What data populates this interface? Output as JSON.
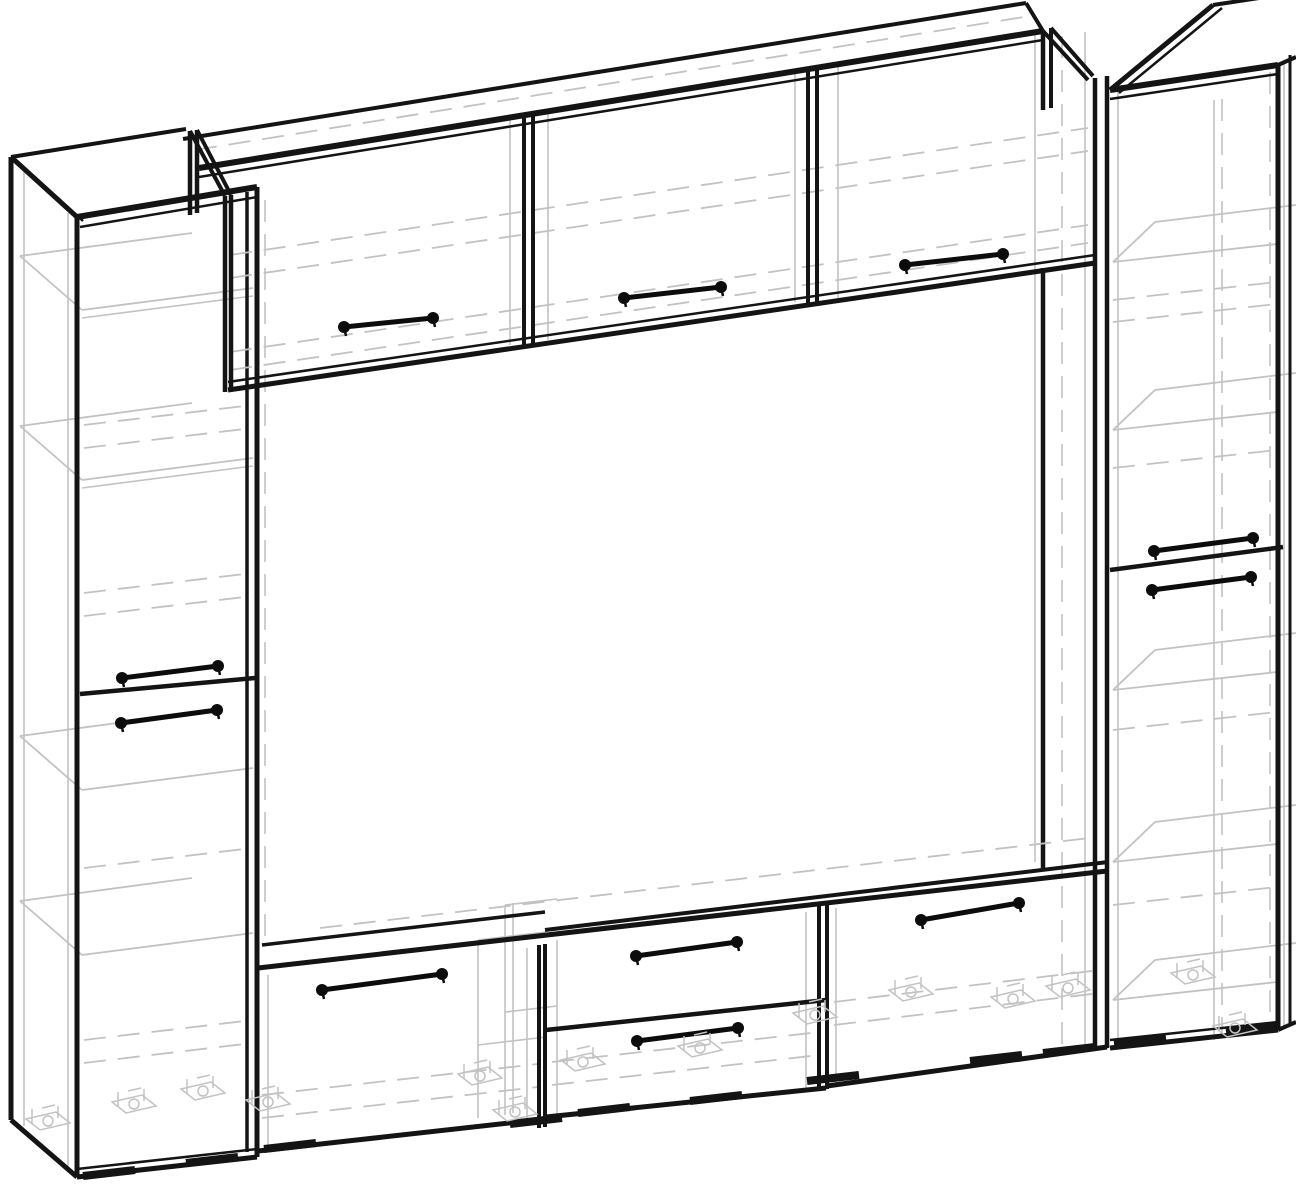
{
  "meta": {
    "type": "furniture-wireframe-diagram",
    "subject": "wall-unit-tv-entertainment-center",
    "canvas": {
      "w": 1296,
      "h": 1194
    },
    "background": "#ffffff"
  },
  "style": {
    "edge_color": "#141414",
    "hidden_color": "#c2c2c2",
    "handle_color": "#0c0c0c",
    "dash_pattern": "22 12",
    "pad_len": 52,
    "pad_drop": -6,
    "pad_width": 8
  },
  "legend": {
    "edges_format": "[x1,y1,x2,y2,strokeWidth] visible edge, black",
    "hidden_format": "[x1,y1,x2,y2,strokeWidth,dashedFlag] hidden/internal edge, light gray",
    "handles_format": "bar handle with ball ends, from->to",
    "pads_format": "[x,y] black floor pad strip",
    "glides_format": "[x,y] gray adjustable-foot hardware glyph"
  },
  "components": {
    "left-tall-cabinet": {
      "edges": [
        [
          11,
          157,
          11,
          1120,
          5
        ],
        [
          11,
          157,
          77,
          217,
          5
        ],
        [
          17,
          161,
          83,
          221,
          2.5
        ],
        [
          11,
          1120,
          77,
          1177,
          5
        ],
        [
          77,
          217,
          77,
          1177,
          5
        ],
        [
          77,
          217,
          257,
          187,
          6
        ],
        [
          80,
          227,
          257,
          197,
          2.5
        ],
        [
          11,
          157,
          186,
          129,
          4
        ],
        [
          247,
          192,
          247,
          1152,
          3.5
        ],
        [
          257,
          187,
          257,
          1157,
          5
        ],
        [
          77,
          1177,
          257,
          1157,
          5
        ],
        [
          77,
          1169,
          257,
          1149,
          2.5
        ],
        [
          80,
          694,
          255,
          678,
          4.5
        ]
      ],
      "hidden": [
        [
          24,
          168,
          24,
          1126,
          1.6,
          0
        ],
        [
          68,
          213,
          68,
          1172,
          1.6,
          0
        ],
        [
          265,
          200,
          265,
          945,
          1.6,
          1
        ],
        [
          82,
          310,
          253,
          288,
          1.8,
          0
        ],
        [
          82,
          310,
          20,
          256,
          1.8,
          0
        ],
        [
          20,
          256,
          192,
          233,
          1.8,
          0
        ],
        [
          82,
          318,
          253,
          296,
          1.6,
          0
        ],
        [
          82,
          480,
          253,
          458,
          1.8,
          0
        ],
        [
          82,
          480,
          20,
          426,
          1.8,
          0
        ],
        [
          20,
          426,
          192,
          403,
          1.8,
          0
        ],
        [
          82,
          488,
          253,
          466,
          1.6,
          0
        ],
        [
          82,
          790,
          253,
          768,
          1.8,
          0
        ],
        [
          82,
          790,
          20,
          736,
          1.8,
          0
        ],
        [
          20,
          736,
          192,
          713,
          1.8,
          0
        ],
        [
          82,
          955,
          253,
          933,
          1.8,
          0
        ],
        [
          82,
          955,
          20,
          901,
          1.8,
          0
        ],
        [
          20,
          901,
          192,
          878,
          1.8,
          0
        ],
        [
          84,
          425,
          253,
          405,
          1.8,
          1
        ],
        [
          84,
          448,
          253,
          428,
          1.8,
          1
        ],
        [
          84,
          593,
          253,
          573,
          1.8,
          1
        ],
        [
          84,
          616,
          253,
          596,
          1.8,
          1
        ],
        [
          84,
          868,
          253,
          848,
          1.8,
          1
        ],
        [
          84,
          1040,
          253,
          1020,
          1.8,
          1
        ],
        [
          84,
          1063,
          253,
          1043,
          1.8,
          1
        ]
      ],
      "handles": [
        {
          "name": "left-cabinet-upper-door-handle",
          "from": [
            122,
            678
          ],
          "to": [
            218,
            666
          ]
        },
        {
          "name": "left-cabinet-lower-door-handle",
          "from": [
            121,
            723
          ],
          "to": [
            217,
            710
          ]
        }
      ]
    },
    "top-bridge-cabinet": {
      "edges": [
        [
          190,
          131,
          190,
          215,
          4.5
        ],
        [
          197,
          130,
          197,
          213,
          4.5
        ],
        [
          190,
          131,
          225,
          196,
          4
        ],
        [
          197,
          130,
          231,
          195,
          4
        ],
        [
          225,
          196,
          225,
          392,
          4.5
        ],
        [
          231,
          195,
          231,
          390,
          4.5
        ],
        [
          199,
          168,
          1043,
          31,
          6
        ],
        [
          199,
          177,
          1043,
          40,
          2.5
        ],
        [
          183,
          139,
          1026,
          3,
          4
        ],
        [
          1026,
          3,
          1043,
          31,
          4
        ],
        [
          228,
          390,
          1095,
          263,
          5
        ],
        [
          228,
          382,
          1095,
          255,
          2.5
        ],
        [
          524,
          116,
          524,
          348,
          4
        ],
        [
          533,
          115,
          533,
          346,
          4
        ],
        [
          808,
          70,
          808,
          306,
          4
        ],
        [
          817,
          69,
          817,
          304,
          4
        ],
        [
          1043,
          31,
          1043,
          110,
          4.5
        ],
        [
          1051,
          28,
          1051,
          108,
          4
        ],
        [
          1043,
          31,
          1088,
          80,
          4
        ],
        [
          1051,
          28,
          1093,
          76,
          4
        ],
        [
          1043,
          268,
          1043,
          868,
          4.5
        ]
      ],
      "hidden": [
        [
          510,
          119,
          510,
          345,
          1.6,
          0
        ],
        [
          548,
          112,
          548,
          340,
          1.6,
          0
        ],
        [
          795,
          73,
          795,
          302,
          1.6,
          0
        ],
        [
          838,
          66,
          838,
          298,
          1.6,
          0
        ],
        [
          1035,
          34,
          1035,
          862,
          1.6,
          0
        ],
        [
          230,
          255,
          1088,
          128,
          1.8,
          1
        ],
        [
          230,
          278,
          1088,
          151,
          1.8,
          1
        ],
        [
          230,
          352,
          1088,
          225,
          1.8,
          1
        ],
        [
          230,
          370,
          1088,
          243,
          1.8,
          1
        ],
        [
          195,
          150,
          1030,
          16,
          1.8,
          1
        ],
        [
          1062,
          36,
          1062,
          1048,
          1.6,
          1
        ],
        [
          1085,
          32,
          1085,
          1046,
          1.6,
          0
        ]
      ],
      "handles": [
        {
          "name": "bridge-door-1-handle",
          "from": [
            344,
            327
          ],
          "to": [
            433,
            318
          ]
        },
        {
          "name": "bridge-door-2-handle",
          "from": [
            624,
            298
          ],
          "to": [
            721,
            287
          ]
        },
        {
          "name": "bridge-door-3-handle",
          "from": [
            905,
            265
          ],
          "to": [
            1003,
            254
          ]
        }
      ]
    },
    "right-tall-cabinet": {
      "edges": [
        [
          1095,
          78,
          1095,
          1050,
          4.5
        ],
        [
          1107,
          76,
          1107,
          1048,
          4.5
        ],
        [
          1110,
          90,
          1278,
          65,
          6
        ],
        [
          1110,
          99,
          1278,
          74,
          2.5
        ],
        [
          1110,
          90,
          1213,
          5,
          5
        ],
        [
          1119,
          93,
          1222,
          8,
          2.5
        ],
        [
          1213,
          5,
          1292,
          -7,
          4
        ],
        [
          1278,
          65,
          1296,
          57,
          4
        ],
        [
          1278,
          65,
          1278,
          1030,
          5
        ],
        [
          1290,
          55,
          1290,
          1026,
          3
        ],
        [
          1110,
          1048,
          1278,
          1030,
          5
        ],
        [
          1110,
          1040,
          1278,
          1022,
          2.5
        ],
        [
          1278,
          1030,
          1296,
          1022,
          4
        ],
        [
          1110,
          570,
          1283,
          547,
          4.5
        ]
      ],
      "hidden": [
        [
          1118,
          82,
          1118,
          1044,
          1.6,
          0
        ],
        [
          1214,
          100,
          1214,
          1040,
          1.6,
          0
        ],
        [
          1222,
          99,
          1222,
          1038,
          1.6,
          1
        ],
        [
          1270,
          72,
          1270,
          1030,
          1.6,
          1
        ],
        [
          1284,
          60,
          1284,
          1028,
          1.6,
          0
        ],
        [
          1113,
          262,
          1277,
          244,
          1.8,
          0
        ],
        [
          1113,
          262,
          1155,
          222,
          1.8,
          0
        ],
        [
          1155,
          222,
          1296,
          205,
          1.8,
          0
        ],
        [
          1113,
          430,
          1277,
          412,
          1.8,
          0
        ],
        [
          1113,
          430,
          1155,
          390,
          1.8,
          0
        ],
        [
          1155,
          390,
          1296,
          373,
          1.8,
          0
        ],
        [
          1113,
          690,
          1277,
          672,
          1.8,
          0
        ],
        [
          1113,
          690,
          1155,
          650,
          1.8,
          0
        ],
        [
          1155,
          650,
          1296,
          633,
          1.8,
          0
        ],
        [
          1113,
          862,
          1277,
          844,
          1.8,
          0
        ],
        [
          1113,
          862,
          1155,
          822,
          1.8,
          0
        ],
        [
          1155,
          822,
          1296,
          805,
          1.8,
          0
        ],
        [
          1113,
          1000,
          1277,
          982,
          1.8,
          0
        ],
        [
          1113,
          1000,
          1155,
          960,
          1.8,
          0
        ],
        [
          1155,
          960,
          1296,
          943,
          1.8,
          0
        ],
        [
          1113,
          300,
          1277,
          282,
          1.8,
          1
        ],
        [
          1113,
          322,
          1277,
          304,
          1.8,
          1
        ],
        [
          1113,
          468,
          1277,
          450,
          1.8,
          1
        ],
        [
          1113,
          730,
          1277,
          712,
          1.8,
          1
        ],
        [
          1113,
          905,
          1277,
          887,
          1.8,
          1
        ]
      ],
      "handles": [
        {
          "name": "right-cabinet-upper-door-handle",
          "from": [
            1154,
            551
          ],
          "to": [
            1253,
            538
          ]
        },
        {
          "name": "right-cabinet-lower-door-handle",
          "from": [
            1152,
            590
          ],
          "to": [
            1251,
            577
          ]
        }
      ]
    },
    "tv-stand-base": {
      "edges": [
        [
          258,
          968,
          1107,
          871,
          5
        ],
        [
          545,
          930,
          1108,
          862,
          4
        ],
        [
          262,
          945,
          545,
          912,
          3.5
        ],
        [
          539,
          945,
          539,
          1128,
          4
        ],
        [
          545,
          944,
          545,
          1127,
          4
        ],
        [
          819,
          905,
          819,
          1090,
          4
        ],
        [
          827,
          904,
          827,
          1089,
          4
        ],
        [
          546,
          1030,
          826,
          1000,
          4.5
        ],
        [
          258,
          1151,
          545,
          1119,
          5
        ],
        [
          546,
          1117,
          826,
          1088,
          5
        ],
        [
          827,
          1086,
          1107,
          1047,
          5
        ]
      ],
      "hidden": [
        [
          268,
          975,
          268,
          1148,
          1.6,
          0
        ],
        [
          527,
          948,
          527,
          1125,
          1.6,
          0
        ],
        [
          557,
          940,
          557,
          1122,
          1.6,
          0
        ],
        [
          806,
          912,
          806,
          1092,
          1.6,
          0
        ],
        [
          836,
          908,
          836,
          1086,
          1.6,
          0
        ],
        [
          478,
          940,
          478,
          1118,
          1.6,
          0
        ],
        [
          505,
          905,
          505,
          1115,
          1.6,
          0
        ],
        [
          513,
          903,
          513,
          1113,
          1.6,
          0
        ],
        [
          478,
          940,
          546,
          932,
          1.6,
          0
        ],
        [
          505,
          905,
          557,
          899,
          1.6,
          0
        ],
        [
          478,
          1045,
          546,
          1037,
          1.6,
          0
        ],
        [
          505,
          1012,
          557,
          1006,
          1.6,
          0
        ],
        [
          320,
          928,
          1090,
          838,
          1.8,
          1
        ],
        [
          262,
          1095,
          538,
          1064,
          1.8,
          1
        ],
        [
          262,
          1118,
          538,
          1087,
          1.8,
          1
        ],
        [
          552,
          1062,
          820,
          1032,
          1.8,
          1
        ],
        [
          552,
          1085,
          820,
          1055,
          1.8,
          1
        ],
        [
          834,
          1002,
          1100,
          970,
          1.8,
          1
        ],
        [
          834,
          1025,
          1100,
          993,
          1.8,
          1
        ]
      ],
      "handles": [
        {
          "name": "stand-left-door-handle",
          "from": [
            322,
            990
          ],
          "to": [
            442,
            974
          ]
        },
        {
          "name": "stand-top-drawer-handle",
          "from": [
            636,
            956
          ],
          "to": [
            737,
            942
          ]
        },
        {
          "name": "stand-bottom-drawer-handle",
          "from": [
            637,
            1041
          ],
          "to": [
            738,
            1028
          ]
        },
        {
          "name": "stand-right-door-handle",
          "from": [
            921,
            920
          ],
          "to": [
            1019,
            903
          ]
        }
      ]
    },
    "feet": {
      "pads": [
        [
          83,
          1176
        ],
        [
          186,
          1163
        ],
        [
          264,
          1149
        ],
        [
          510,
          1124
        ],
        [
          578,
          1113
        ],
        [
          690,
          1101
        ],
        [
          807,
          1081
        ],
        [
          970,
          1061
        ],
        [
          1043,
          1053
        ],
        [
          1114,
          1044
        ],
        [
          1226,
          1032
        ]
      ],
      "glides": [
        [
          48,
          1121
        ],
        [
          134,
          1104
        ],
        [
          203,
          1091
        ],
        [
          268,
          1102
        ],
        [
          480,
          1076
        ],
        [
          515,
          1112
        ],
        [
          583,
          1062
        ],
        [
          700,
          1048
        ],
        [
          815,
          1015
        ],
        [
          911,
          992
        ],
        [
          1013,
          999
        ],
        [
          1068,
          988
        ],
        [
          1193,
          975
        ],
        [
          1235,
          1028
        ]
      ]
    }
  }
}
